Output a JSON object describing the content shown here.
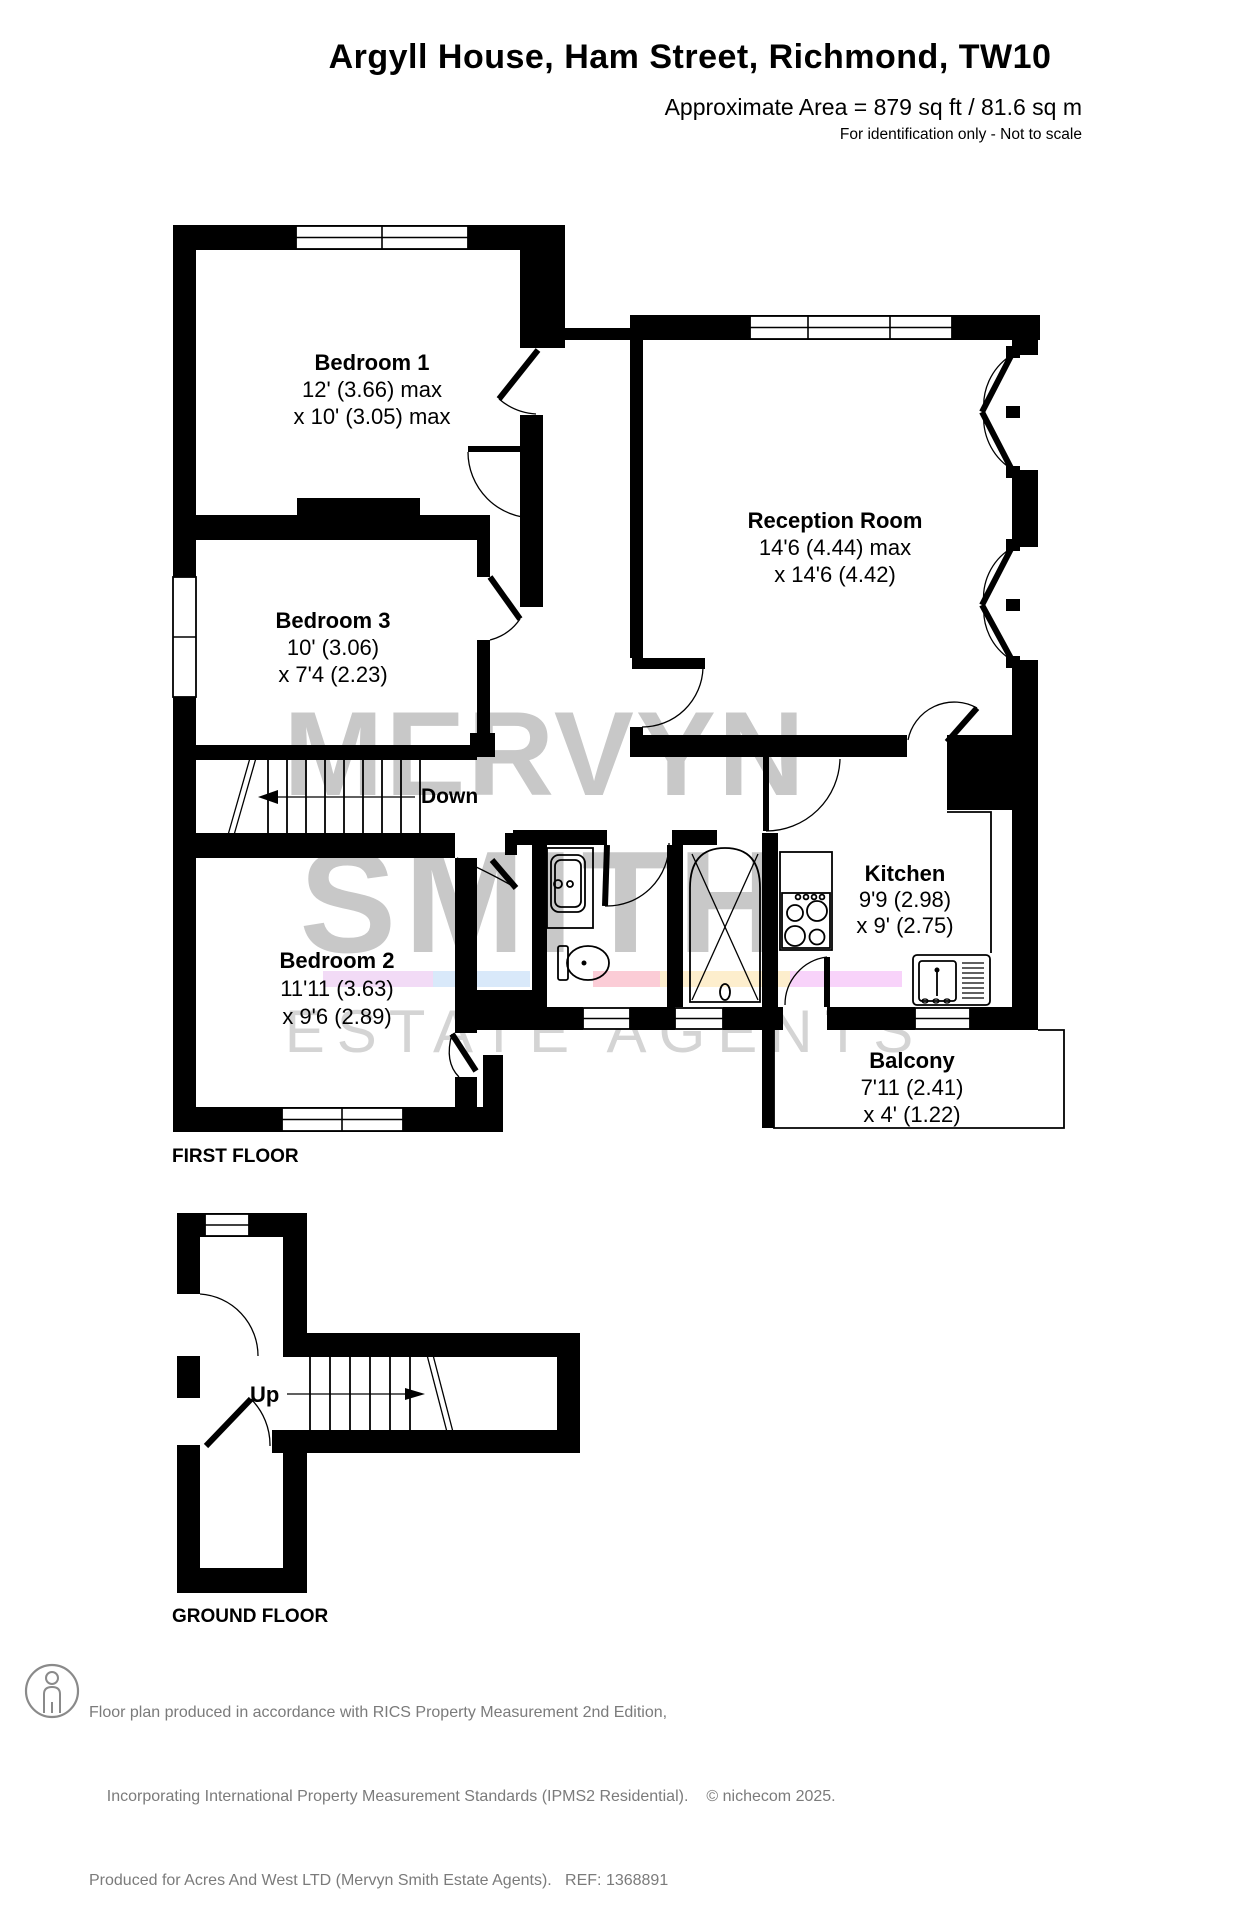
{
  "header": {
    "title": "Argyll House, Ham Street, Richmond, TW10",
    "area": "Approximate Area = 879 sq ft / 81.6 sq m",
    "disclaimer": "For identification only - Not to scale"
  },
  "watermark": {
    "word1": "MERVYN",
    "word2": "SMITH",
    "word3": "ESTATE AGENTS"
  },
  "colors": {
    "wall": "#000000",
    "watermark_text": "#c8c8c8",
    "watermark_sub": "#d4d4d4",
    "stripes": [
      "#f2dbf6",
      "#d9e9fa",
      "#fbccd6",
      "#fdeecd",
      "#f8d3fa"
    ]
  },
  "first_floor": {
    "label": "FIRST FLOOR",
    "stair_label": "Down",
    "rooms": {
      "bedroom1": {
        "name": "Bedroom 1",
        "dim1": "12' (3.66) max",
        "dim2": "x 10' (3.05) max"
      },
      "reception": {
        "name": "Reception Room",
        "dim1": "14'6 (4.44) max",
        "dim2": "x 14'6 (4.42)"
      },
      "bedroom3": {
        "name": "Bedroom 3",
        "dim1": "10' (3.06)",
        "dim2": "x 7'4 (2.23)"
      },
      "kitchen": {
        "name": "Kitchen",
        "dim1": "9'9 (2.98)",
        "dim2": "x 9' (2.75)"
      },
      "bedroom2": {
        "name": "Bedroom 2",
        "dim1": "11'11 (3.63)",
        "dim2": "x 9'6 (2.89)"
      },
      "balcony": {
        "name": "Balcony",
        "dim1": "7'11 (2.41)",
        "dim2": "x 4' (1.22)"
      }
    }
  },
  "ground_floor": {
    "label": "GROUND FLOOR",
    "stair_label": "Up"
  },
  "footer": {
    "line1": "Floor plan produced in accordance with RICS Property Measurement 2nd Edition,",
    "line2": "Incorporating International Property Measurement Standards (IPMS2 Residential).",
    "copyright": "© nichecom 2025.",
    "line3": "Produced for Acres And West LTD (Mervyn Smith Estate Agents).   REF: 1368891"
  }
}
